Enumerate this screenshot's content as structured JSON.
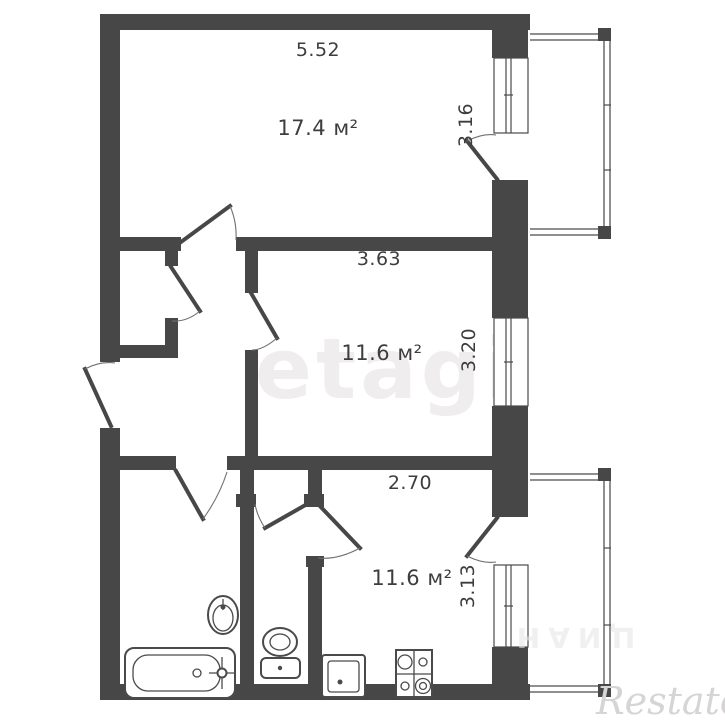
{
  "plan_type": "apartment-floor-plan",
  "rooms": [
    {
      "name": "room-top",
      "area": "17.4 м²",
      "top_dim": "5.52",
      "side_dim": "3.16"
    },
    {
      "name": "room-middle",
      "area": "11.6 м²",
      "top_dim": "3.63",
      "side_dim": "3.20"
    },
    {
      "name": "kitchen",
      "area": "11.6 м²",
      "top_dim": "2.70",
      "side_dim": "3.13"
    }
  ],
  "watermarks": {
    "center": "etagi",
    "corner": "Restate",
    "faint": "ЦИАН"
  },
  "fixtures": [
    "bathtub",
    "bathroom-sink",
    "toilet",
    "kitchen-sink",
    "stove"
  ],
  "colors": {
    "wall": "#474747",
    "fixture_line": "#4a4a4a",
    "balcony_line": "#8f8f8f",
    "label": "#3d3d3d",
    "watermark_center": "#efeded",
    "watermark_corner": "#d6d4d4",
    "background": "#ffffff"
  }
}
